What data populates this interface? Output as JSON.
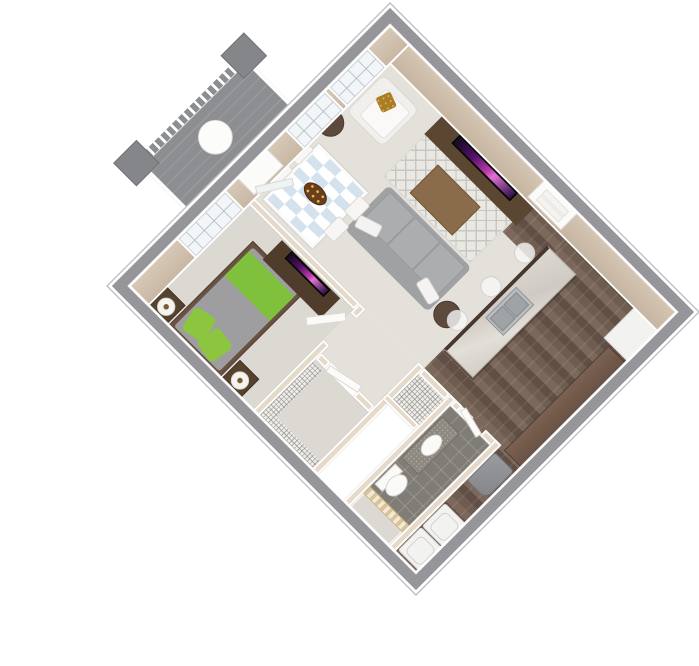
{
  "scene": {
    "kind": "3D isometric floor plan rendering",
    "subject": "One-bedroom, one-bathroom apartment with balcony",
    "background_color": "#ffffff",
    "view": "top-down dimetric view rotated 45 degrees",
    "walls": {
      "interior_face": "#d2c3b1",
      "cap_exterior": "#96969a",
      "trim": "#ffffff",
      "interior_partition": "#e5d9c9"
    }
  },
  "palette": {
    "carpet_living": "#e4e1db",
    "carpet_bedroom": "#dcd9d3",
    "hardwood": "#6f5c50",
    "bathroom_tile": "#807d77",
    "balcony_deck": "#8d8e91",
    "accent_green": "#7fc13d",
    "sofa_gray": "#9fa1a3",
    "walnut_dark": "#5b4631",
    "island_marble": "#d6d2cb",
    "tv_glow": "#b93aa8",
    "dining_checker_blue": "#d4e2ee",
    "gold_pillow": "#a97c28"
  },
  "rooms": [
    {
      "name": "Living Room",
      "floor": "carpet",
      "items": [
        "sofa",
        "armchair",
        "coffee table",
        "area rug",
        "tv console",
        "flat-screen tv",
        "round side table left",
        "round side table right"
      ]
    },
    {
      "name": "Dining Area",
      "floor": "carpet",
      "items": [
        "dining table with blue checkered placemats",
        "4 white chairs",
        "fruit platter"
      ]
    },
    {
      "name": "Kitchen",
      "floor": "hardwood",
      "items": [
        "island with double sink",
        "3 bar stools",
        "counter run",
        "refrigerator"
      ]
    },
    {
      "name": "Entry",
      "floor": "hardwood",
      "items": [
        "front door"
      ]
    },
    {
      "name": "Bedroom",
      "floor": "carpet",
      "items": [
        "queen bed with green runner and pillows",
        "2 nightstands",
        "2 drum lamps",
        "dresser",
        "bedroom tv",
        "window"
      ]
    },
    {
      "name": "Bathroom",
      "floor": "tile",
      "items": [
        "vanity with sink",
        "toilet",
        "shower with striped curtain",
        "door"
      ]
    },
    {
      "name": "Walk-in Closet",
      "floor": "carpet",
      "items": [
        "wire shelving L",
        "door"
      ]
    },
    {
      "name": "Pantry Closet",
      "floor": "wire shelving",
      "items": []
    },
    {
      "name": "Utility / Laundry",
      "floor": "hardwood",
      "items": [
        "water heater",
        "washer",
        "dryer"
      ]
    },
    {
      "name": "Balcony",
      "floor": "deck planks",
      "items": [
        "white railing",
        "2 pillars",
        "round bistro table",
        "glass door"
      ]
    }
  ],
  "windows": {
    "living_room": 2,
    "bedroom": 1
  },
  "doors": [
    "front door",
    "balcony door",
    "bedroom door",
    "bathroom door",
    "closet door",
    "pantry door"
  ]
}
